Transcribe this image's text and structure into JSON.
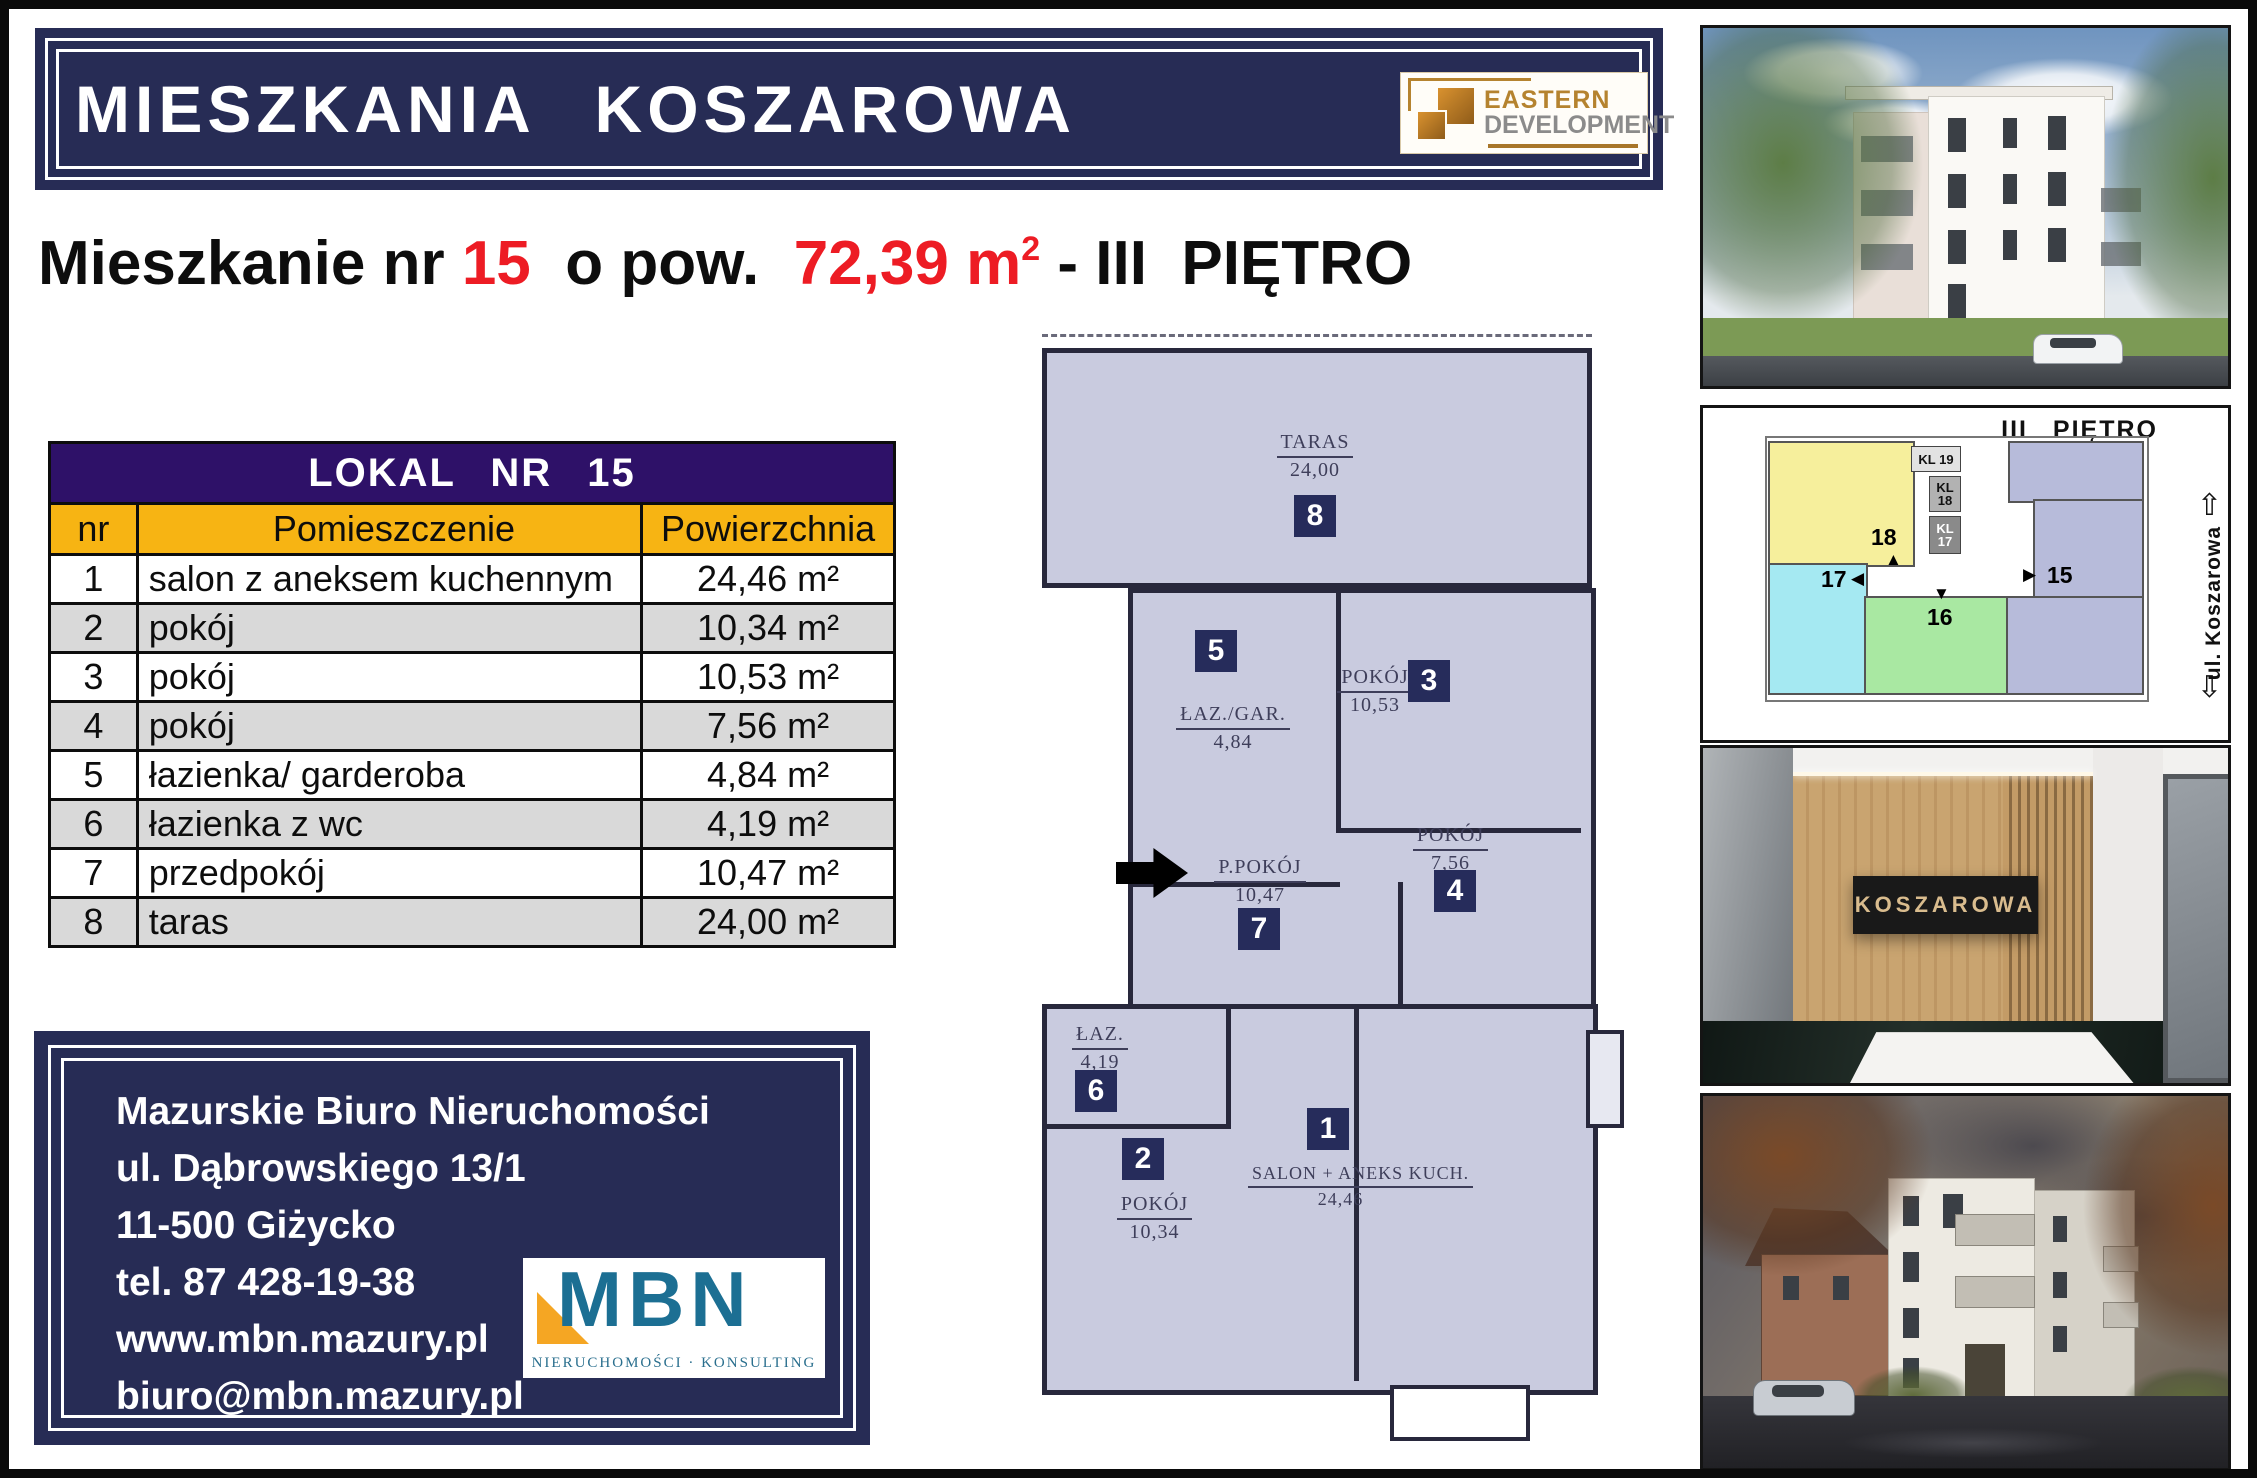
{
  "colors": {
    "navy": "#272c55",
    "table_header_purple": "#2e1168",
    "table_header_gold": "#f7b413",
    "highlight_red": "#ed1c24",
    "plan_fill": "#c9cbdf",
    "badge_navy": "#262c5b",
    "mbn_teal": "#1c6f93",
    "mbn_orange": "#f5a623",
    "ed_bronze": "#b5832f"
  },
  "header": {
    "title": "MIESZKANIA KOSZAROWA",
    "logo": {
      "line1": "EASTERN",
      "line2": "DEVELOPMENT"
    }
  },
  "subtitle": {
    "prefix": "Mieszkanie nr ",
    "number": "15",
    "mid": "  o pow.  ",
    "area": "72,39 m",
    "area_sup": "2",
    "suffix": " - III  PIĘTRO"
  },
  "table": {
    "title": "LOKAL NR 15",
    "columns": [
      "nr",
      "Pomieszczenie",
      "Powierzchnia"
    ],
    "rows": [
      {
        "nr": "1",
        "name": "salon z aneksem kuchennym",
        "area": "24,46 m²"
      },
      {
        "nr": "2",
        "name": "pokój",
        "area": "10,34 m²"
      },
      {
        "nr": "3",
        "name": "pokój",
        "area": "10,53 m²"
      },
      {
        "nr": "4",
        "name": "pokój",
        "area": "7,56 m²"
      },
      {
        "nr": "5",
        "name": "łazienka/ garderoba",
        "area": "4,84 m²"
      },
      {
        "nr": "6",
        "name": "łazienka z wc",
        "area": "4,19 m²"
      },
      {
        "nr": "7",
        "name": "przedpokój",
        "area": "10,47 m²"
      },
      {
        "nr": "8",
        "name": "taras",
        "area": "24,00 m²"
      }
    ]
  },
  "floorplan": {
    "rooms": [
      {
        "badge": "8",
        "label": "TARAS",
        "area": "24,00"
      },
      {
        "badge": "5",
        "label": "ŁAZ./GAR.",
        "area": "4,84"
      },
      {
        "badge": "3",
        "label": "POKÓJ",
        "area": "10,53"
      },
      {
        "badge": "7",
        "label": "P.POKÓJ",
        "area": "10,47"
      },
      {
        "badge": "4",
        "label": "POKÓJ",
        "area": "7,56"
      },
      {
        "badge": "6",
        "label": "ŁAZ.",
        "area": "4,19"
      },
      {
        "badge": "2",
        "label": "POKÓJ",
        "area": "10,34"
      },
      {
        "badge": "1",
        "label": "SALON + ANEKS KUCH.",
        "area": "24,46"
      }
    ]
  },
  "side": {
    "floor_plan": {
      "title": "III PIĘTRO",
      "street": "ul. Koszarowa",
      "stairwells": [
        "KL 19",
        "KL 18",
        "KL 17"
      ],
      "units": [
        "18",
        "17",
        "16",
        "15"
      ]
    },
    "interior": {
      "sign": "KOSZAROWA"
    }
  },
  "contact": {
    "lines": [
      "Mazurskie Biuro Nieruchomości",
      "ul. Dąbrowskiego 13/1",
      "11-500 Giżycko",
      "tel. 87 428-19-38",
      "www.mbn.mazury.pl",
      "biuro@mbn.mazury.pl"
    ],
    "logo": {
      "text": "MBN",
      "subtext": "NIERUCHOMOŚCI · KONSULTING"
    }
  }
}
